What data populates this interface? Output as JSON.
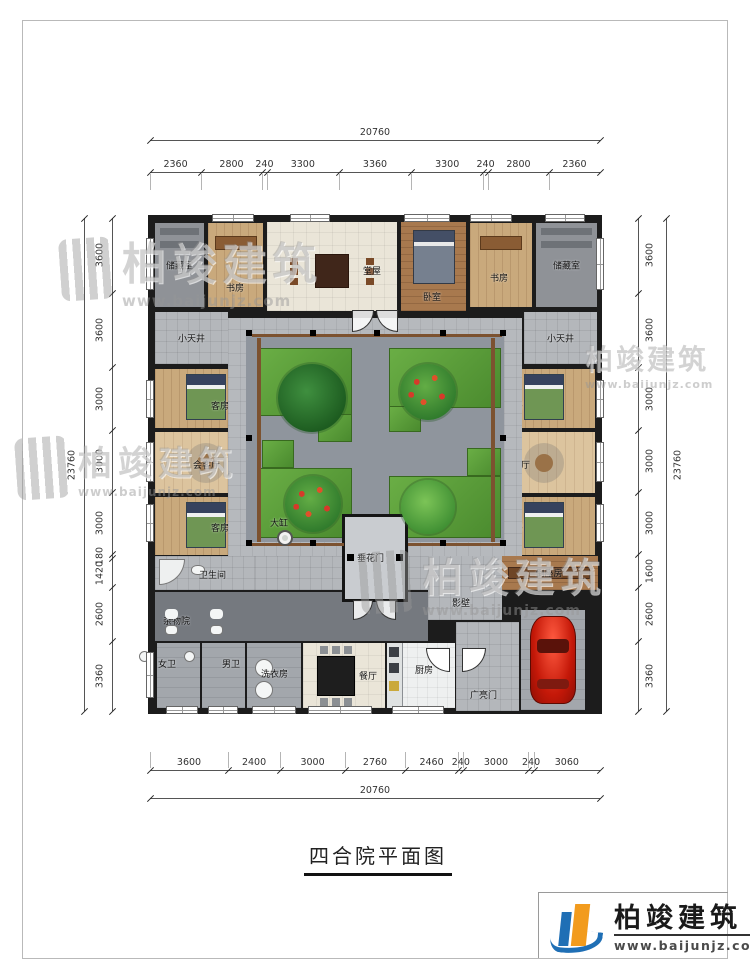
{
  "meta": {
    "title": "四合院平面图"
  },
  "brand": {
    "name": "柏竣建筑",
    "url": "www.baijunjz.com"
  },
  "dims": {
    "top": {
      "total": "20760",
      "segments": [
        "2360",
        "2800",
        "240",
        "3300",
        "3360",
        "3300",
        "240",
        "2800",
        "2360"
      ]
    },
    "bottom": {
      "total": "20760",
      "segments": [
        "3600",
        "2400",
        "3000",
        "2760",
        "2460",
        "240",
        "3000",
        "240",
        "3060"
      ]
    },
    "left": {
      "total": "23760",
      "segments": [
        "3600",
        "3600",
        "3000",
        "3000",
        "3000",
        "180",
        "1420",
        "2600",
        "3360"
      ]
    },
    "right": {
      "total": "23760",
      "segments": [
        "3600",
        "3600",
        "3000",
        "3000",
        "3000",
        "1600",
        "2600",
        "3360"
      ]
    }
  },
  "rooms": [
    {
      "id": "room-storage-nw",
      "label": "储藏室",
      "t": "gray",
      "f": "shelf",
      "x": 155,
      "y": 223,
      "w": 49,
      "h": 84
    },
    {
      "id": "room-study-nw",
      "label": "书房",
      "t": "wood",
      "f": "desk",
      "x": 208,
      "y": 223,
      "w": 55,
      "h": 84,
      "lx": 18,
      "ly": 58
    },
    {
      "id": "room-main-hall",
      "label": "堂屋",
      "t": "tile",
      "f": "hall",
      "x": 267,
      "y": 222,
      "w": 130,
      "h": 89,
      "lx": 96,
      "ly": 42
    },
    {
      "id": "room-bedroom",
      "label": "卧室",
      "t": "wood-dark",
      "f": "bigbed",
      "x": 401,
      "y": 222,
      "w": 65,
      "h": 89,
      "lx": 22,
      "ly": 68
    },
    {
      "id": "room-study-ne",
      "label": "书房",
      "t": "wood",
      "f": "desk",
      "x": 470,
      "y": 223,
      "w": 62,
      "h": 84,
      "lx": 20,
      "ly": 48
    },
    {
      "id": "room-storage-ne",
      "label": "储藏室",
      "t": "gray",
      "f": "shelf",
      "x": 536,
      "y": 223,
      "w": 61,
      "h": 84
    },
    {
      "id": "room-patio-w",
      "label": "小天井",
      "t": "pave",
      "x": 155,
      "y": 312,
      "w": 73,
      "h": 52
    },
    {
      "id": "room-patio-e",
      "label": "小天井",
      "t": "pave",
      "x": 524,
      "y": 312,
      "w": 73,
      "h": 52
    },
    {
      "id": "room-guest-nw",
      "label": "客房",
      "t": "wood",
      "f": "bed",
      "x": 155,
      "y": 369,
      "w": 102,
      "h": 59,
      "lx": 56,
      "ly": 30
    },
    {
      "id": "room-parlor-w",
      "label": "会客厅",
      "t": "wood-light",
      "f": "sofa",
      "x": 155,
      "y": 432,
      "w": 102,
      "h": 61,
      "lx": 38,
      "ly": 26
    },
    {
      "id": "room-guest-sw",
      "label": "客房",
      "t": "wood",
      "f": "bed",
      "x": 155,
      "y": 497,
      "w": 102,
      "h": 58,
      "lx": 56,
      "ly": 24
    },
    {
      "id": "room-guest-ne",
      "label": "客房",
      "t": "wood",
      "f": "bed",
      "x": 493,
      "y": 369,
      "w": 102,
      "h": 59,
      "lx": 12,
      "ly": 30
    },
    {
      "id": "room-parlor-e",
      "label": "会客厅",
      "t": "wood-light",
      "f": "sofa",
      "x": 493,
      "y": 432,
      "w": 102,
      "h": 61,
      "lx": 10,
      "ly": 26
    },
    {
      "id": "room-guest-se",
      "label": "客房",
      "t": "wood",
      "f": "bed",
      "x": 493,
      "y": 497,
      "w": 102,
      "h": 58,
      "lx": 12,
      "ly": 24
    },
    {
      "id": "courtyard",
      "label": "",
      "t": "court",
      "x": 228,
      "y": 318,
      "w": 294,
      "h": 240
    },
    {
      "id": "corridor-front",
      "label": "",
      "t": "pave",
      "x": 255,
      "y": 556,
      "w": 175,
      "h": 34
    },
    {
      "id": "room-bathroom",
      "label": "卫生间",
      "t": "pave",
      "f": "bath",
      "x": 155,
      "y": 556,
      "w": 100,
      "h": 34,
      "lx": 44,
      "ly": 12
    },
    {
      "id": "room-daozuo",
      "label": "倒座房",
      "t": "wood-dark",
      "f": "bench",
      "x": 500,
      "y": 556,
      "w": 98,
      "h": 34
    },
    {
      "id": "passage-screenwall",
      "label": "影壁",
      "t": "pave",
      "x": 428,
      "y": 556,
      "w": 74,
      "h": 64,
      "lx": 24,
      "ly": 40
    },
    {
      "id": "room-sundry-yard",
      "label": "杂物院",
      "t": "dark",
      "x": 155,
      "y": 592,
      "w": 273,
      "h": 49,
      "lx": 8,
      "ly": 22
    },
    {
      "id": "room-toilet-women",
      "label": "女卫",
      "t": "pave2",
      "f": "wc",
      "x": 157,
      "y": 643,
      "w": 43,
      "h": 65,
      "lx": 1,
      "ly": 14
    },
    {
      "id": "room-toilet-men",
      "label": "男卫",
      "t": "pave2",
      "f": "wc",
      "x": 202,
      "y": 643,
      "w": 43,
      "h": 65,
      "lx": 20,
      "ly": 14
    },
    {
      "id": "room-laundry",
      "label": "洗衣房",
      "t": "pave2",
      "f": "washers",
      "x": 247,
      "y": 643,
      "w": 54,
      "h": 65,
      "lx": 14,
      "ly": 24
    },
    {
      "id": "room-dining",
      "label": "餐厅",
      "t": "tile",
      "f": "dining",
      "x": 303,
      "y": 643,
      "w": 82,
      "h": 65,
      "lx": 56,
      "ly": 26
    },
    {
      "id": "room-kitchen",
      "label": "厨房",
      "t": "white",
      "f": "kitchen",
      "x": 387,
      "y": 643,
      "w": 68,
      "h": 65,
      "lx": 28,
      "ly": 20
    },
    {
      "id": "main-gate",
      "label": "广亮门",
      "t": "pave",
      "f": "gatedoors",
      "x": 456,
      "y": 622,
      "w": 63,
      "h": 89,
      "lx": 14,
      "ly": 66
    },
    {
      "id": "garage",
      "label": "",
      "t": "pave2",
      "f": "car",
      "x": 521,
      "y": 610,
      "w": 64,
      "h": 100
    },
    {
      "id": "festoon-gate",
      "label": "垂花门",
      "t": "gatehouse",
      "x": 342,
      "y": 514,
      "w": 66,
      "h": 88,
      "lx": 12,
      "ly": 34
    }
  ],
  "planters": [
    {
      "x": 260,
      "y": 348,
      "w": 90,
      "h": 66
    },
    {
      "x": 389,
      "y": 348,
      "w": 110,
      "h": 58
    },
    {
      "x": 318,
      "y": 414,
      "w": 32,
      "h": 26
    },
    {
      "x": 389,
      "y": 406,
      "w": 30,
      "h": 24
    },
    {
      "x": 260,
      "y": 468,
      "w": 90,
      "h": 68
    },
    {
      "x": 389,
      "y": 476,
      "w": 110,
      "h": 60
    },
    {
      "x": 262,
      "y": 440,
      "w": 30,
      "h": 26
    },
    {
      "x": 467,
      "y": 448,
      "w": 32,
      "h": 26
    }
  ],
  "trees": [
    {
      "k": "t-dark",
      "x": 312,
      "y": 398,
      "r": 34
    },
    {
      "k": "t-dotted",
      "x": 428,
      "y": 392,
      "r": 28
    },
    {
      "k": "t-dotted",
      "x": 313,
      "y": 504,
      "r": 28
    },
    {
      "k": "t-green",
      "x": 428,
      "y": 507,
      "r": 27
    }
  ],
  "vat": {
    "label": "大缸",
    "x": 285,
    "y": 538,
    "lx": 270,
    "ly": 516
  },
  "columns": [
    [
      246,
      330
    ],
    [
      310,
      330
    ],
    [
      374,
      330
    ],
    [
      440,
      330
    ],
    [
      500,
      330
    ],
    [
      246,
      435
    ],
    [
      246,
      540
    ],
    [
      500,
      435
    ],
    [
      500,
      540
    ],
    [
      310,
      540
    ],
    [
      440,
      540
    ]
  ],
  "strips": [
    [
      257,
      338,
      4,
      204
    ],
    [
      491,
      338,
      4,
      204
    ],
    [
      252,
      334,
      250,
      3
    ],
    [
      252,
      543,
      92,
      3
    ],
    [
      408,
      543,
      92,
      3
    ]
  ],
  "windows": [
    [
      212,
      214,
      42,
      8
    ],
    [
      290,
      214,
      40,
      8
    ],
    [
      404,
      214,
      46,
      8
    ],
    [
      470,
      214,
      42,
      8
    ],
    [
      545,
      214,
      40,
      8
    ],
    [
      146,
      238,
      8,
      52
    ],
    [
      146,
      380,
      8,
      38
    ],
    [
      146,
      442,
      8,
      40
    ],
    [
      146,
      504,
      8,
      38
    ],
    [
      146,
      652,
      8,
      46
    ],
    [
      596,
      238,
      8,
      52
    ],
    [
      596,
      380,
      8,
      38
    ],
    [
      596,
      442,
      8,
      40
    ],
    [
      596,
      504,
      8,
      38
    ],
    [
      166,
      706,
      32,
      8
    ],
    [
      208,
      706,
      30,
      8
    ],
    [
      252,
      706,
      44,
      8
    ],
    [
      308,
      706,
      64,
      8
    ],
    [
      392,
      706,
      52,
      8
    ]
  ],
  "doors": [
    {
      "x": 352,
      "y": 310,
      "r": 22,
      "o": "d-br"
    },
    {
      "x": 376,
      "y": 310,
      "r": 22,
      "o": "d-bl"
    },
    {
      "x": 353,
      "y": 600,
      "r": 20,
      "o": "d-br"
    },
    {
      "x": 376,
      "y": 600,
      "r": 20,
      "o": "d-bl"
    }
  ]
}
